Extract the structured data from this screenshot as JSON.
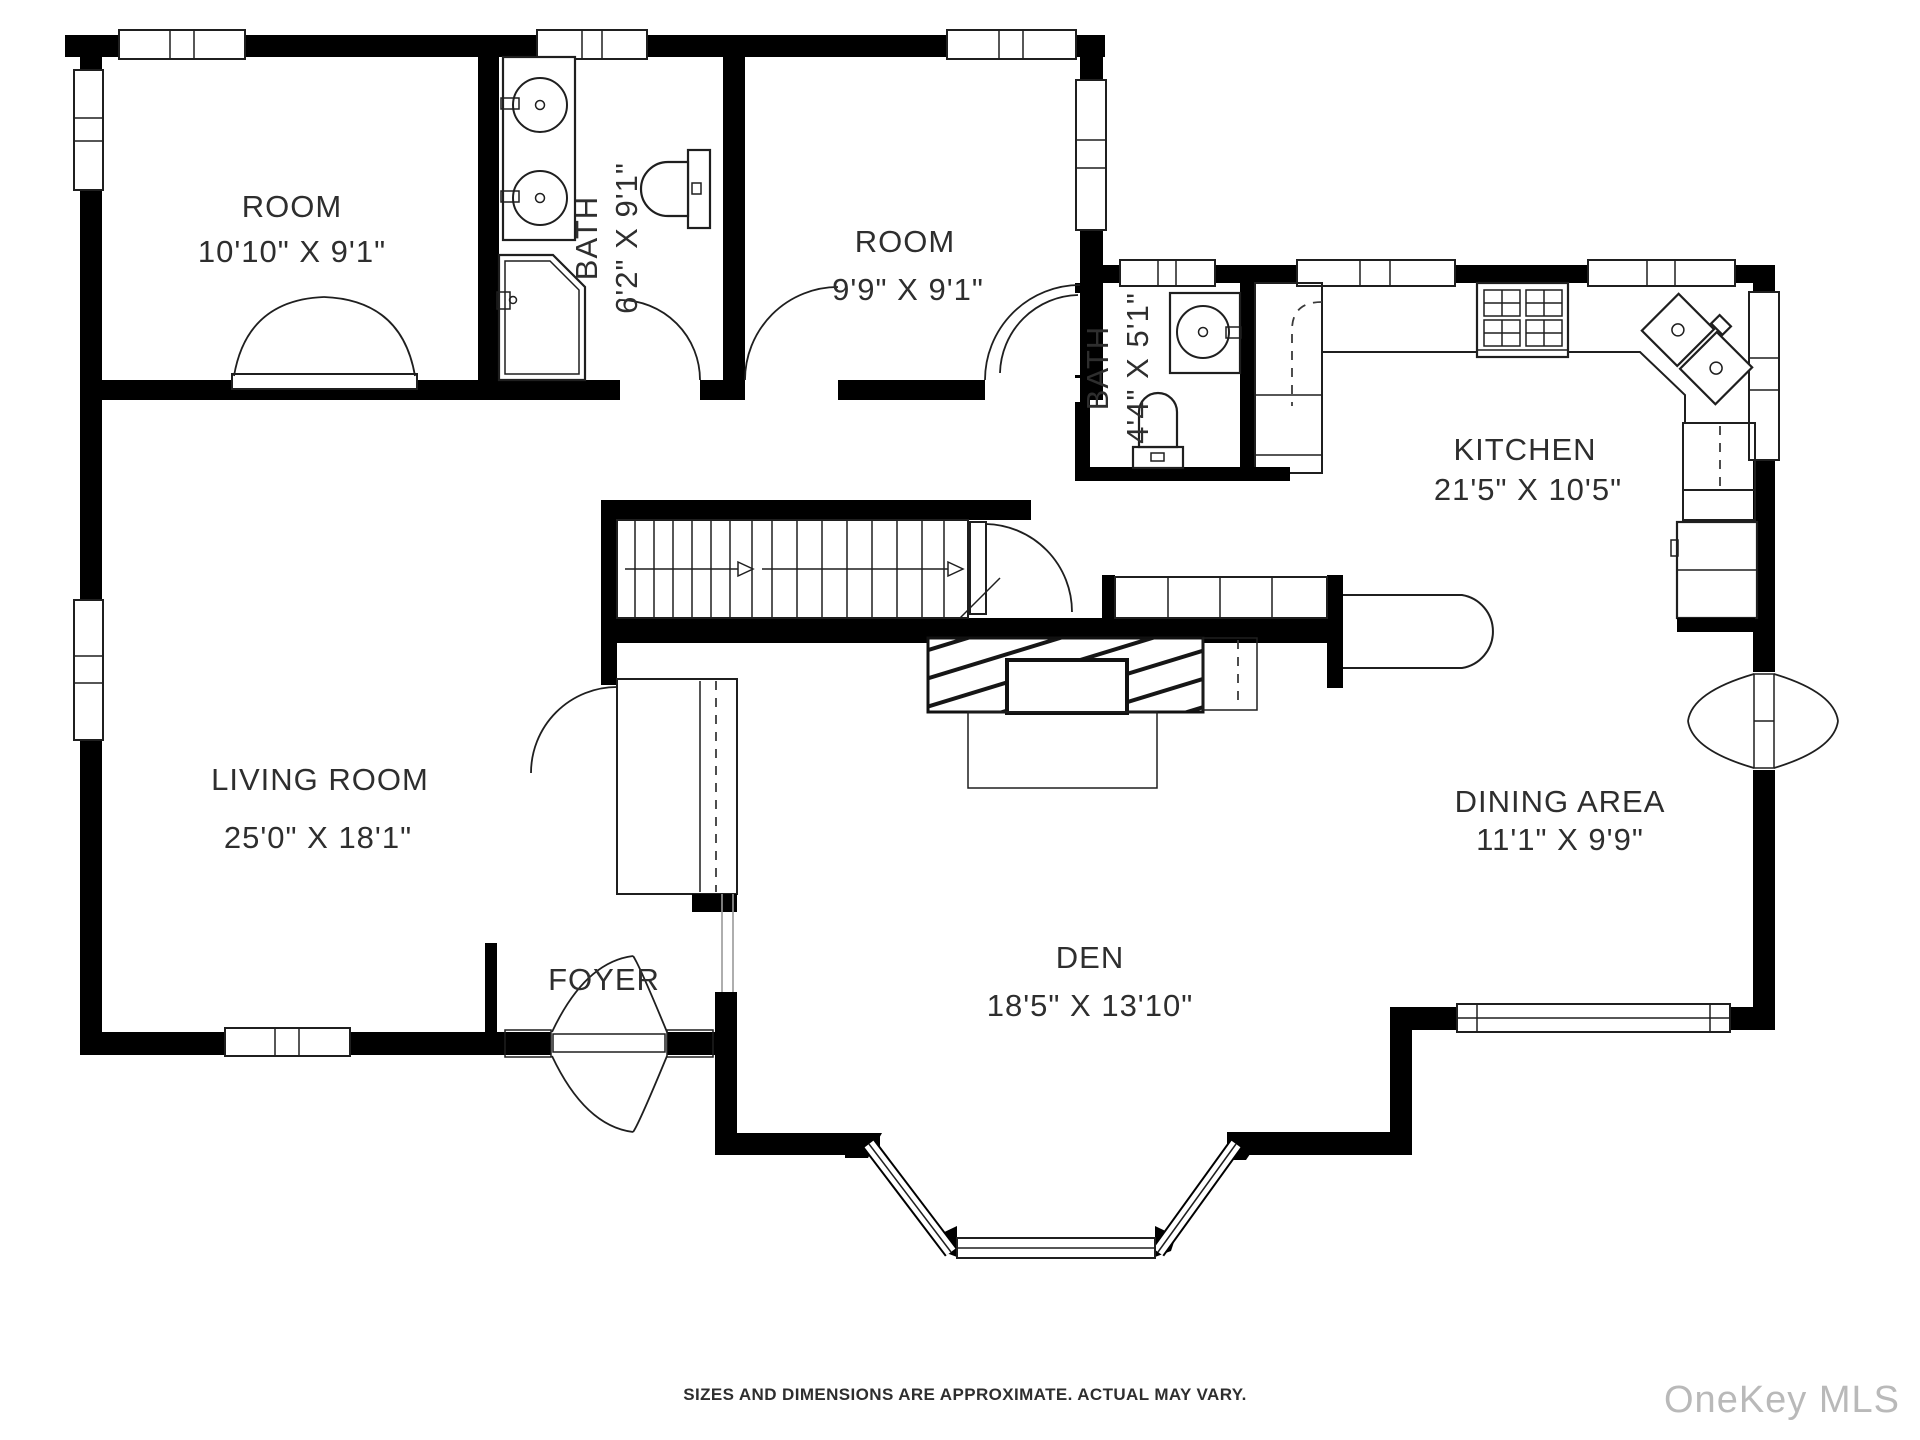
{
  "rooms": [
    {
      "id": "room-1",
      "name": "ROOM",
      "dims": "10'10\" X 9'1\""
    },
    {
      "id": "bath-1",
      "name": "BATH",
      "dims": "6'2\" X 9'1\""
    },
    {
      "id": "room-2",
      "name": "ROOM",
      "dims": "9'9\" X 9'1\""
    },
    {
      "id": "bath-2",
      "name": "BATH",
      "dims": "4'4\" X 5'1\""
    },
    {
      "id": "kitchen",
      "name": "KITCHEN",
      "dims": "21'5\" X 10'5\""
    },
    {
      "id": "living-room",
      "name": "LIVING ROOM",
      "dims": "25'0\" X 18'1\""
    },
    {
      "id": "foyer",
      "name": "FOYER",
      "dims": ""
    },
    {
      "id": "den",
      "name": "DEN",
      "dims": "18'5\" X 13'10\""
    },
    {
      "id": "dining-area",
      "name": "DINING AREA",
      "dims": "11'1\" X 9'9\""
    }
  ],
  "footer": {
    "disclaimer": "SIZES AND DIMENSIONS ARE APPROXIMATE. ACTUAL MAY VARY."
  },
  "watermark": {
    "text": "OneKey MLS"
  },
  "colors": {
    "wall": "#000000",
    "line": "#1f1f1f",
    "text": "#2e2e2e",
    "watermark": "#b9b9b9",
    "background": "#ffffff"
  }
}
